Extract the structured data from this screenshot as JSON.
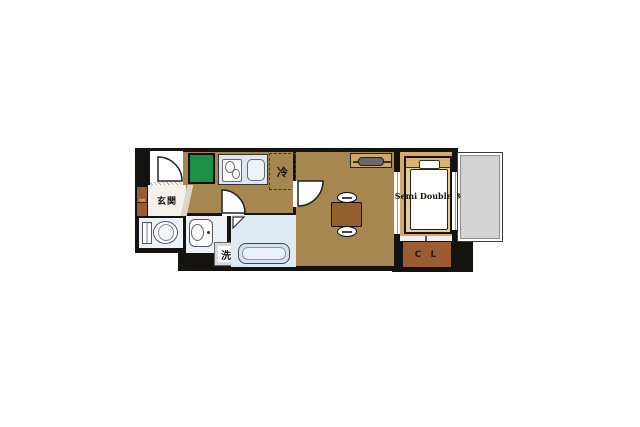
{
  "canvas": {
    "width": 640,
    "height": 427,
    "background": "#ffffff"
  },
  "floorplan": {
    "type": "japanese-apartment-floor-plan",
    "labels": {
      "entrance": "玄関",
      "shoe_box": "SB",
      "refrigerator": "冷",
      "washing_machine": "洗",
      "bed_size": "Semi Double ※",
      "closet": "C L"
    },
    "colors": {
      "wall": "#151310",
      "floor_main": "#a6874f",
      "floor_bedroom": "#d5aa68",
      "bed_frame": "#e9cc93",
      "headboard": "#d8b470",
      "closet_brown": "#9b5c33",
      "table_brown": "#935f2d",
      "green_box": "#1d9047",
      "fixture_fill": "#dde7f1",
      "wet_floor": "#ebf1f7",
      "bath_floor": "#e0eaf3",
      "balcony_fill": "#d3d3d3",
      "genkan_fill": "#f4f1ea"
    }
  }
}
